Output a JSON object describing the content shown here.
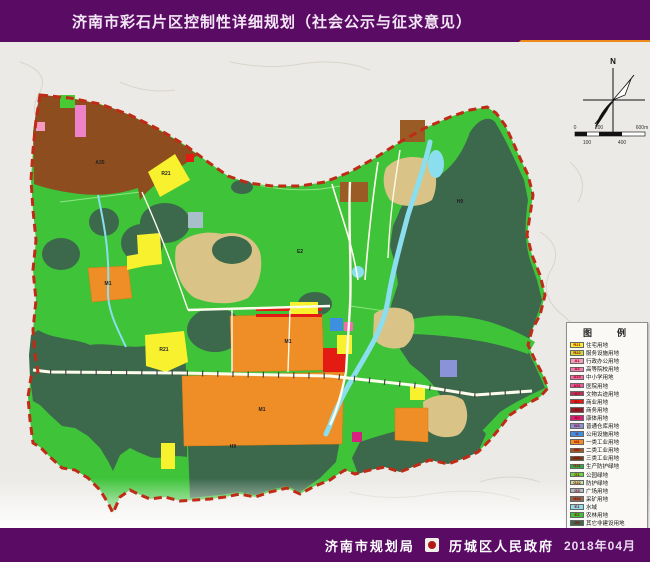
{
  "header": {
    "title": "济南市彩石片区控制性详细规划（社会公示与征求意见）"
  },
  "tab": {
    "label": "用地规划图"
  },
  "compass": {
    "north_label": "N"
  },
  "scale_bar": {
    "labels_top": [
      "0",
      "200",
      "600m"
    ],
    "labels_bottom": [
      "100",
      "400"
    ]
  },
  "legend": {
    "title": "图　例",
    "items": [
      {
        "code": "R21",
        "label": "住宅用地",
        "color": "#F8F22E"
      },
      {
        "code": "R22",
        "label": "服务设施用地",
        "color": "#CEDC3A"
      },
      {
        "code": "A1",
        "label": "行政办公用地",
        "color": "#F49BC1"
      },
      {
        "code": "A3",
        "label": "高等院校用地",
        "color": "#F07FB5"
      },
      {
        "code": "A33",
        "label": "中小学用地",
        "color": "#EE6FAC"
      },
      {
        "code": "A51",
        "label": "医院用地",
        "color": "#E85A9E"
      },
      {
        "code": "A7",
        "label": "文物古迹用地",
        "color": "#B5305A"
      },
      {
        "code": "B1",
        "label": "商业用地",
        "color": "#E31B12"
      },
      {
        "code": "B2",
        "label": "商务用地",
        "color": "#8C1F28"
      },
      {
        "code": "B3",
        "label": "康体用地",
        "color": "#D6217E"
      },
      {
        "code": "W1",
        "label": "普通仓库用地",
        "color": "#8A92D8"
      },
      {
        "code": "U",
        "label": "公用设施用地",
        "color": "#3F8FE0"
      },
      {
        "code": "M1",
        "label": "一类工业用地",
        "color": "#EF8D26"
      },
      {
        "code": "M2",
        "label": "二类工业用地",
        "color": "#9A5B24"
      },
      {
        "code": "M3",
        "label": "三类工业用地",
        "color": "#6E3D1A"
      },
      {
        "code": "G21",
        "label": "生产防护绿地",
        "color": "#2EAE46"
      },
      {
        "code": "G1",
        "label": "公园绿地",
        "color": "#63D73F"
      },
      {
        "code": "G22",
        "label": "防护绿地",
        "color": "#BCE79E"
      },
      {
        "code": "G3",
        "label": "广场用地",
        "color": "#A7BECB"
      },
      {
        "code": "H54",
        "label": "采矿用地",
        "color": "#8B6C50"
      },
      {
        "code": "E1",
        "label": "水域",
        "color": "#8ADEEE"
      },
      {
        "code": "E2",
        "label": "农林用地",
        "color": "#3EC339"
      },
      {
        "code": "H9",
        "label": "其它非建设用地",
        "color": "#3C684C"
      },
      {
        "code": "",
        "label": "规划用地边界",
        "color": "#BF2B16",
        "style": "dash"
      }
    ]
  },
  "map_labels": [
    {
      "text": "A35",
      "x": 100,
      "y": 121
    },
    {
      "text": "R21",
      "x": 166,
      "y": 132
    },
    {
      "text": "M1",
      "x": 108,
      "y": 242
    },
    {
      "text": "R21",
      "x": 164,
      "y": 308
    },
    {
      "text": "M1",
      "x": 288,
      "y": 300
    },
    {
      "text": "M1",
      "x": 262,
      "y": 368
    },
    {
      "text": "E2",
      "x": 300,
      "y": 210
    },
    {
      "text": "H9",
      "x": 460,
      "y": 160
    },
    {
      "text": "H9",
      "x": 233,
      "y": 405
    }
  ],
  "footer": {
    "agency_left": "济南市规划局",
    "agency_right": "历城区人民政府",
    "date": "2018年04月"
  },
  "colors": {
    "banner": "#5A0B64",
    "tab": "#EE8A1C",
    "boundary": "#BF2B16",
    "farmland": "#3EC339",
    "mountain": "#3C684C",
    "background": "#ECEAE6"
  }
}
